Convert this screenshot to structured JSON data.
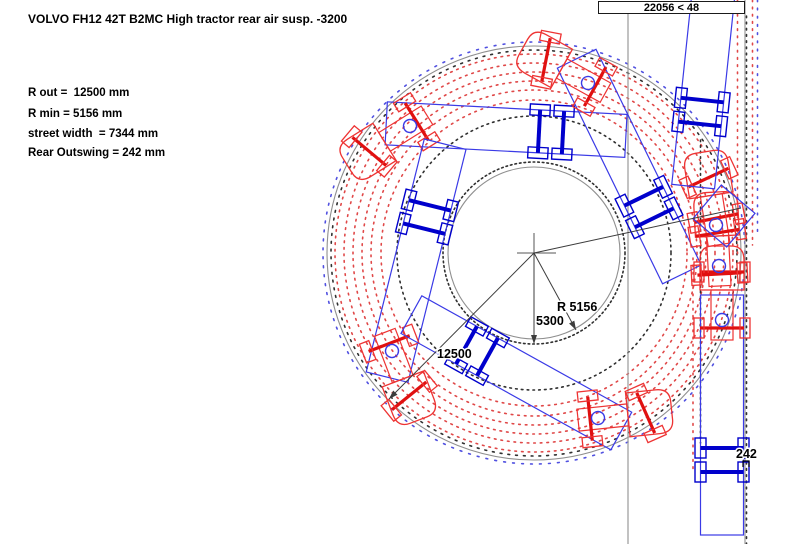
{
  "title": "VOLVO FH12 42T B2MC High tractor rear air susp. -3200",
  "measurements": [
    "R out =  12500 mm",
    "R min = 5156 mm",
    "street width  = 7344 mm",
    "Rear Outswing = 242 mm"
  ],
  "status_box": {
    "text": "22056 < 48"
  },
  "colors": {
    "trailer_outline": "#3a3ae6",
    "axle_blue": "#0000cc",
    "tractor_red": "#ee3333",
    "axle_red": "#e01010",
    "fifth_wheel_blue": "#3a3ae6",
    "circle_gray": "#8f8f8f",
    "lane_gray": "#9a9a9a",
    "dim_line": "#3c3c3c",
    "dot_red": "#e04848",
    "dot_blue": "#5050e0",
    "dot_black": "#303030",
    "text": "#000000"
  },
  "diagram": {
    "center": {
      "x": 534,
      "y": 253
    },
    "outer_circle_r": 207,
    "inner_circle_r": 86,
    "tick_rings": [
      {
        "color": "dot_blue",
        "r": 211,
        "dash": "1.8 7.2"
      },
      {
        "color": "dot_black",
        "r": 203,
        "dash": "1.8 6.0"
      }
    ],
    "wheel_rings": {
      "color": "dot_red",
      "radii": [
        153,
        163,
        172,
        181,
        190,
        199
      ],
      "dash": "1.6 5.0"
    },
    "body_rings": [
      {
        "r": 91,
        "dash": "1.6 3.0"
      },
      {
        "r": 137,
        "dash": "1.6 4.2"
      }
    ],
    "lanes": [
      {
        "x": 628,
        "y1": 14,
        "y2": 544
      },
      {
        "x": 745,
        "y1": 0,
        "y2": 544
      }
    ],
    "dot_columns": [
      {
        "x": 746.5,
        "y1": 16,
        "y2": 544,
        "color": "dot_black",
        "dash": "1.6 4.6"
      },
      {
        "x": 700.5,
        "y1": 140,
        "y2": 443,
        "color": "dot_black",
        "dash": "1.6 4.0"
      },
      {
        "x": 737.5,
        "y1": 0,
        "y2": 258,
        "color": "dot_red",
        "dash": "1.6 5.6"
      },
      {
        "x": 752.5,
        "y1": 0,
        "y2": 245,
        "color": "dot_red",
        "dash": "1.6 5.6"
      },
      {
        "x": 693.0,
        "y1": 258,
        "y2": 470,
        "color": "dot_red",
        "dash": "1.6 5.6"
      },
      {
        "x": 757.5,
        "y1": 0,
        "y2": 235,
        "color": "dot_blue",
        "dash": "1.6 6.6"
      }
    ],
    "vehicles": [
      {
        "name": "snapshot-top",
        "trailer": {
          "x": 551,
          "y": 132,
          "h": 183
        },
        "tractor": {
          "x": 410,
          "y": 126,
          "h": 148,
          "steer": -18
        }
      },
      {
        "name": "snapshot-left",
        "trailer": {
          "x": 427,
          "y": 217,
          "h": 104
        },
        "tractor": {
          "x": 392,
          "y": 351,
          "h": 69,
          "steer": -18
        }
      },
      {
        "name": "snapshot-bottom",
        "trailer": {
          "x": 477,
          "y": 351,
          "h": 29
        },
        "tractor": {
          "x": 598,
          "y": 418,
          "h": -6,
          "steer": -18
        }
      },
      {
        "name": "snapshot-upper-right",
        "trailer": {
          "x": 649,
          "y": 207,
          "h": 244
        },
        "tractor": {
          "x": 588,
          "y": 83,
          "h": 209,
          "steer": -18
        }
      },
      {
        "name": "lane-straight",
        "trailer": {
          "x": 722,
          "y": 460,
          "h": 270
        },
        "tractor": {
          "x": 722,
          "y": 320,
          "h": 270,
          "steer": 0
        }
      },
      {
        "name": "lane-turning-1",
        "tractor": {
          "x": 719,
          "y": 266,
          "h": 267,
          "steer": -8
        }
      },
      {
        "name": "lane-turning-2",
        "tractor": {
          "x": 716,
          "y": 225,
          "h": 261,
          "steer": -16
        }
      },
      {
        "name": "lane-exit-trailer",
        "trailer": {
          "x": 701,
          "y": 112,
          "h": 276
        }
      }
    ],
    "extra_square": {
      "x": 724,
      "y": 216,
      "size": 44,
      "rot": 40
    },
    "crosshair": {
      "x": 534,
      "y": 253,
      "hx1": 517,
      "hx2": 556,
      "vy1": 233,
      "vy2": 270
    },
    "annotations": [
      {
        "name": "radius-outer",
        "type": "arrow",
        "x1": 534,
        "y1": 253,
        "x2": 389,
        "y2": 399,
        "label": "12500",
        "lx": 437,
        "ly": 358
      },
      {
        "name": "radius-inner",
        "type": "arrow",
        "x1": 534,
        "y1": 253,
        "x2": 576,
        "y2": 330,
        "label": "R 5156",
        "lx": 557,
        "ly": 311
      },
      {
        "name": "radius-mid",
        "type": "arrow",
        "x1": 534,
        "y1": 253,
        "x2": 534,
        "y2": 344,
        "label": "5300",
        "lx": 536,
        "ly": 325
      },
      {
        "name": "tangent-line",
        "type": "line",
        "x1": 534,
        "y1": 253,
        "x2": 741,
        "y2": 208,
        "label": "",
        "lx": 0,
        "ly": 0
      }
    ],
    "outswing": {
      "label": "242",
      "lx": 736,
      "ly": 458,
      "bx": 743,
      "by": 461
    }
  }
}
